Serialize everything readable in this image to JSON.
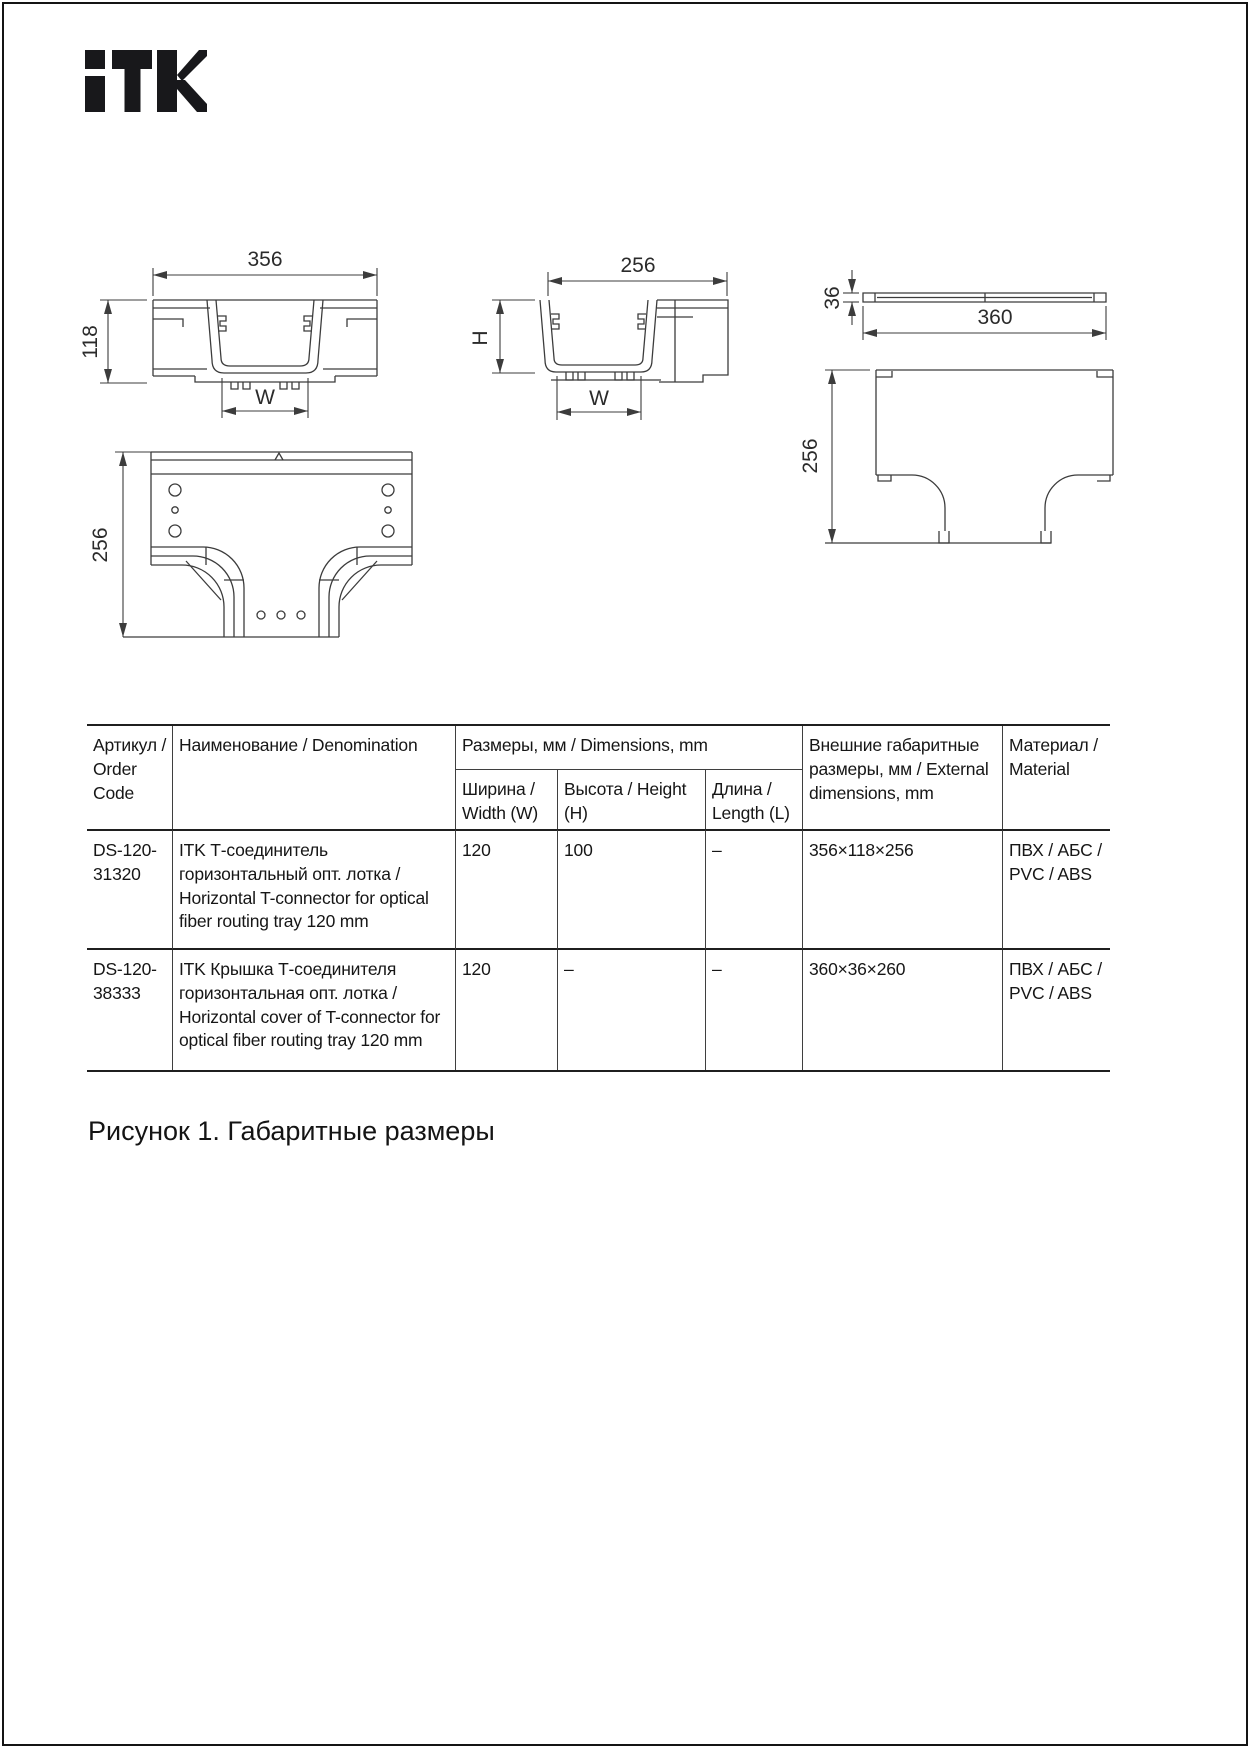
{
  "brand": {
    "name": "ITK"
  },
  "figure": {
    "caption": "Рисунок 1. Габаритные размеры",
    "views": {
      "front": {
        "width": "356",
        "height": "118",
        "tray_width": "W"
      },
      "section": {
        "width": "256",
        "height": "H",
        "tray_width": "W"
      },
      "cover": {
        "thickness": "36",
        "width": "360",
        "depth": "256"
      },
      "plan": {
        "depth": "256"
      }
    }
  },
  "table": {
    "header": {
      "order_code": "Артикул / Order Code",
      "denomination": "Наименование / Denomination",
      "dimensions": "Размеры, мм / Dimensions, mm",
      "width": "Ширина / Width (W)",
      "height": "Высота / Height (H)",
      "length": "Длина / Length (L)",
      "external": "Внешние габаритные размеры, мм / External dimensions, mm",
      "material": "Материал / Material"
    },
    "rows": [
      {
        "code": "DS-120-31320",
        "name": "ITK Т-соединитель горизонтальный опт. лотка / Horizontal T-connector for optical fiber routing tray 120 mm",
        "width": "120",
        "height": "100",
        "length": "–",
        "external": "356×118×256",
        "material": "ПВХ / АБС / PVC / ABS"
      },
      {
        "code": "DS-120-38333",
        "name": "ITK Крышка Т-соединителя горизонтальная опт. лотка / Horizontal cover of T-connector for optical fiber routing tray 120 mm",
        "width": "120",
        "height": "–",
        "length": "–",
        "external": "360×36×260",
        "material": "ПВХ / АБС / PVC / ABS"
      }
    ]
  }
}
